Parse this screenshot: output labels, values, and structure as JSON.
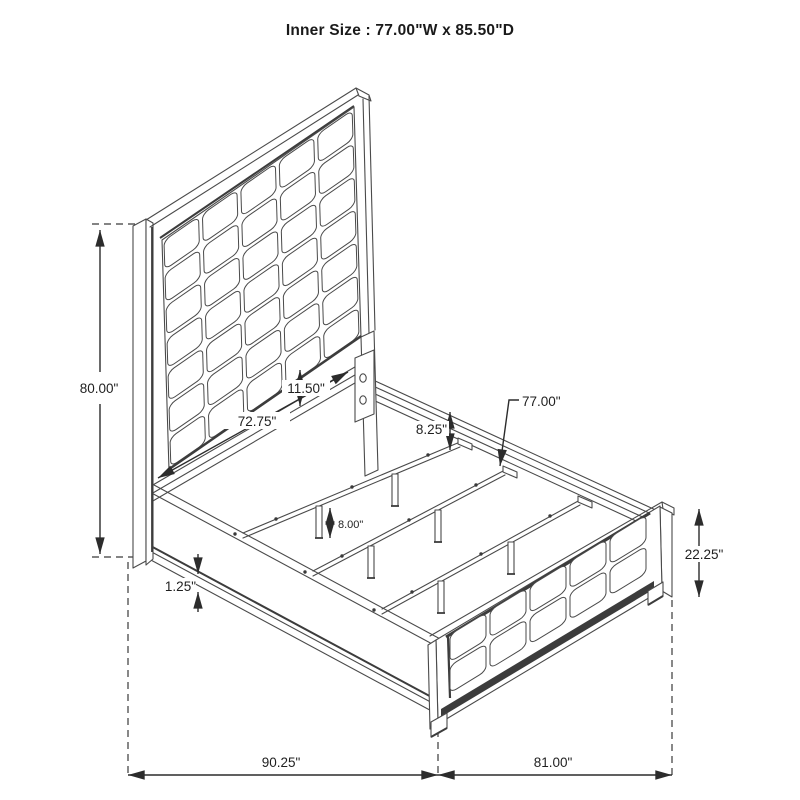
{
  "title": "Inner Size : 77.00\"W x 85.50\"D",
  "dimensions": {
    "headboard_height": "80.00\"",
    "headboard_width": "72.75\"",
    "headboard_panel_to_rail_gap": "11.50\"",
    "slat_leg_height": "8.00\"",
    "side_rail_to_slat_drop": "8.25\"",
    "slat_length": "77.00\"",
    "footboard_height": "22.25\"",
    "rail_base_trim": "1.25\"",
    "overall_depth": "90.25\"",
    "overall_width": "81.00\""
  },
  "colors": {
    "line": "#4a4a4a",
    "heavy": "#3c3c3c",
    "text": "#1f1f1f",
    "background": "#ffffff"
  }
}
